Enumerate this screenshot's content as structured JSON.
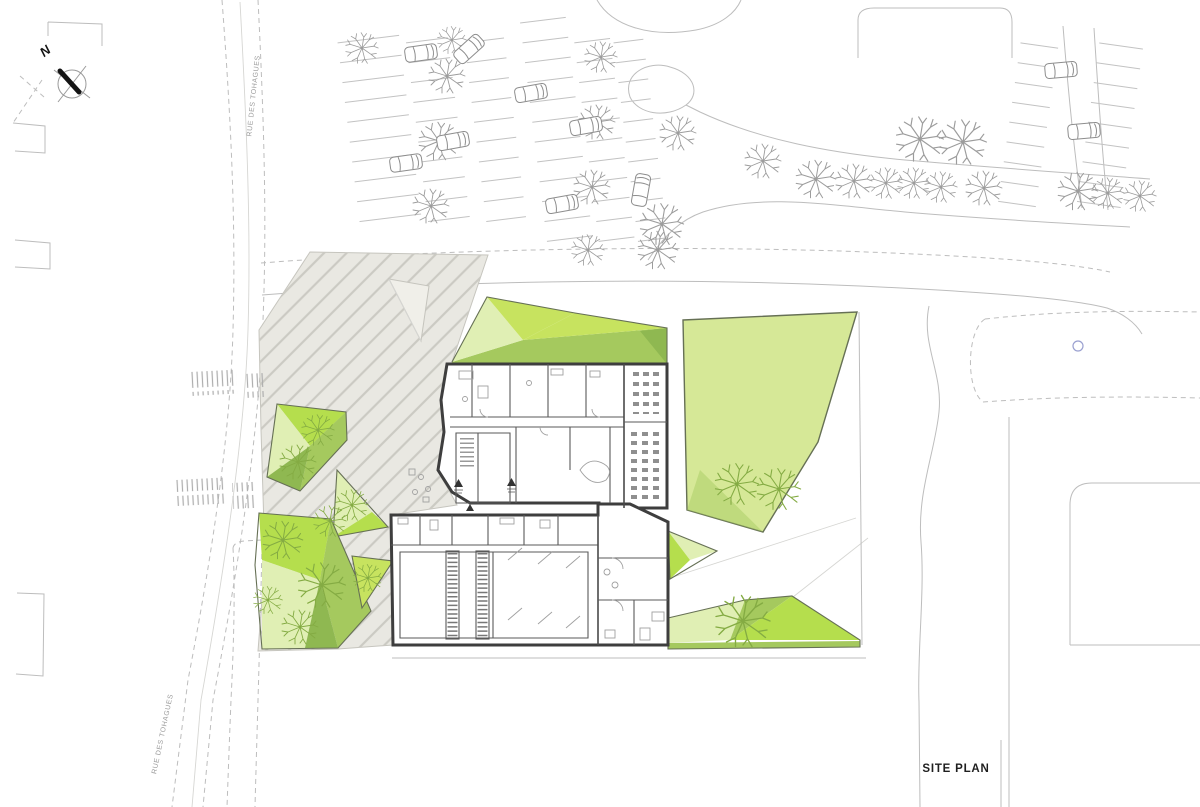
{
  "plan": {
    "title": "SITE PLAN",
    "compass_label": "N",
    "drawing_type": "architectural site plan"
  },
  "streets": {
    "top": "RUE DES TOHAGUES",
    "bottom": "RUE DES TOHAGUES"
  },
  "icons": {
    "north_arrow": "compass-circle-with-needle",
    "tree": "sketched-branch-tree",
    "car": "parked-car-outline"
  },
  "colors": {
    "paper": "#ffffff",
    "line_light": "#bdbdbd",
    "text_gray": "#9b9b9b",
    "text_dark": "#1f1f1f",
    "wall": "#3e3e3e",
    "hatch_fill": "#e9e8e2",
    "hatch_line": "#cbcac3",
    "pale_tri": "#f0efe9",
    "green_pale": "#d6e897",
    "green_light": "#e0efb4",
    "green_bright": "#c7e35f",
    "green_vivid": "#b5de4d",
    "green_mid": "#a5c95e",
    "green_dark": "#8fb851",
    "green_outline": "#667055",
    "tree_green": "#84ab43",
    "tree_gray": "#9c9c9c",
    "car": "#8d8d8d",
    "stall": "#c2c2c2",
    "zebra": "#adadad",
    "circle_blue": "#9aa0d0"
  }
}
